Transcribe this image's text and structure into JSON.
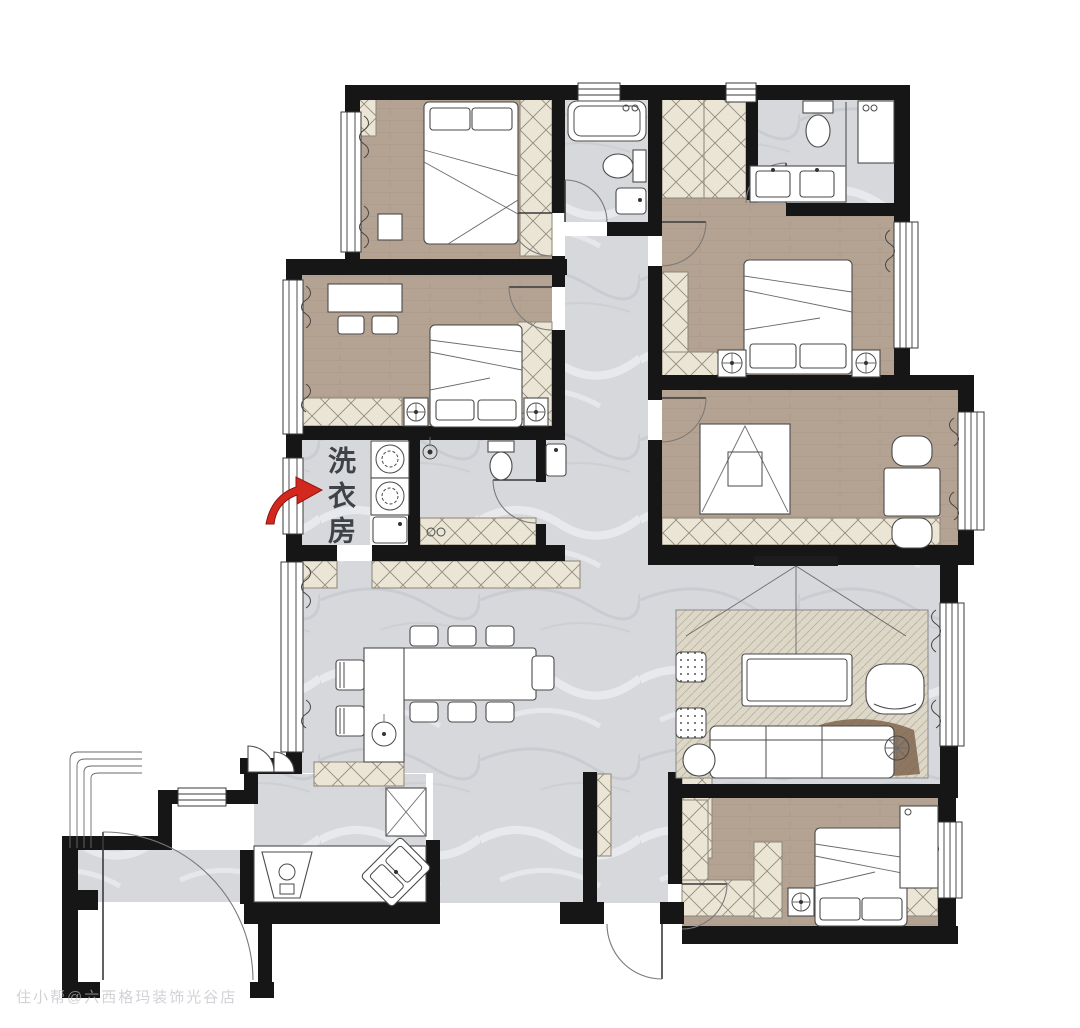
{
  "plan": {
    "labels": {
      "laundry_room": "洗衣房"
    },
    "watermark": "住小帮@六西格玛装饰光谷店",
    "annotation_arrow": {
      "target": "laundry-room",
      "direction": "pointing-right-into-room"
    },
    "colors": {
      "wall": "#161616",
      "wood": "#b4a393",
      "wood_line": "#9d8b7b",
      "marble": "#d6d8db",
      "marble_vein": "#c6c9ce",
      "hatch_bg": "#ebe5d5",
      "hatch_line": "#948c7e",
      "furniture": "#ffffff",
      "outline": "#4a4a4a",
      "accent_red": "#d2281e",
      "label": "#3f4347",
      "rug": "#ddd7c8",
      "rug_blob": "#7b5f47",
      "watermark": "#b7bbc1"
    },
    "rooms": [
      {
        "id": "bedroom-top-left",
        "type": "bedroom",
        "floor": "wood",
        "furniture": [
          "double-bed",
          "wardrobe",
          "dresser"
        ]
      },
      {
        "id": "ensuite-bathroom",
        "type": "bathroom",
        "floor": "marble",
        "furniture": [
          "bathtub",
          "toilet",
          "sink"
        ]
      },
      {
        "id": "bedroom-top-right",
        "type": "bedroom",
        "floor": "wood",
        "furniture": [
          "double-bed",
          "closet-row",
          "nightstands"
        ]
      },
      {
        "id": "bathroom-top-right",
        "type": "bathroom",
        "floor": "marble",
        "furniture": [
          "double-vanity",
          "toilet",
          "shower",
          "tall-cabinet"
        ]
      },
      {
        "id": "bedroom-mid-left",
        "type": "bedroom",
        "floor": "wood",
        "furniture": [
          "double-bed",
          "desk",
          "chairs",
          "wardrobe",
          "nightstands"
        ]
      },
      {
        "id": "laundry-room",
        "type": "utility",
        "floor": "marble",
        "label": "洗衣房",
        "furniture": [
          "washer",
          "dryer",
          "laundry-sink"
        ]
      },
      {
        "id": "shower-room",
        "type": "bathroom",
        "floor": "marble",
        "furniture": [
          "shower",
          "floor-drain",
          "toilet",
          "sink"
        ]
      },
      {
        "id": "study",
        "type": "study",
        "floor": "wood",
        "furniture": [
          "drafting-desk",
          "tea-table",
          "chairs",
          "low-cabinet"
        ]
      },
      {
        "id": "living-room",
        "type": "living",
        "floor": "marble",
        "furniture": [
          "sofa",
          "coffee-table",
          "rug",
          "tv",
          "armchair",
          "poufs",
          "floor-lamp",
          "side-table"
        ]
      },
      {
        "id": "dining-room",
        "type": "dining",
        "floor": "marble",
        "furniture": [
          "dining-table",
          "six-chairs",
          "island-counter",
          "bar-stools",
          "curved-cabinet"
        ]
      },
      {
        "id": "kitchen",
        "type": "kitchen",
        "floor": "marble",
        "furniture": [
          "range-hood",
          "cooktop",
          "corner-sink",
          "fridge",
          "counter"
        ]
      },
      {
        "id": "bedroom-bottom-right",
        "type": "bedroom",
        "floor": "wood",
        "furniture": [
          "double-bed",
          "wardrobes",
          "nightstands",
          "tall-cabinet"
        ]
      },
      {
        "id": "entry",
        "type": "entry",
        "floor": "marble",
        "furniture": [
          "porch-steps",
          "entry-door"
        ]
      },
      {
        "id": "hallway",
        "type": "hallway",
        "floor": "marble",
        "furniture": [
          "hall-cabinets"
        ]
      }
    ]
  }
}
